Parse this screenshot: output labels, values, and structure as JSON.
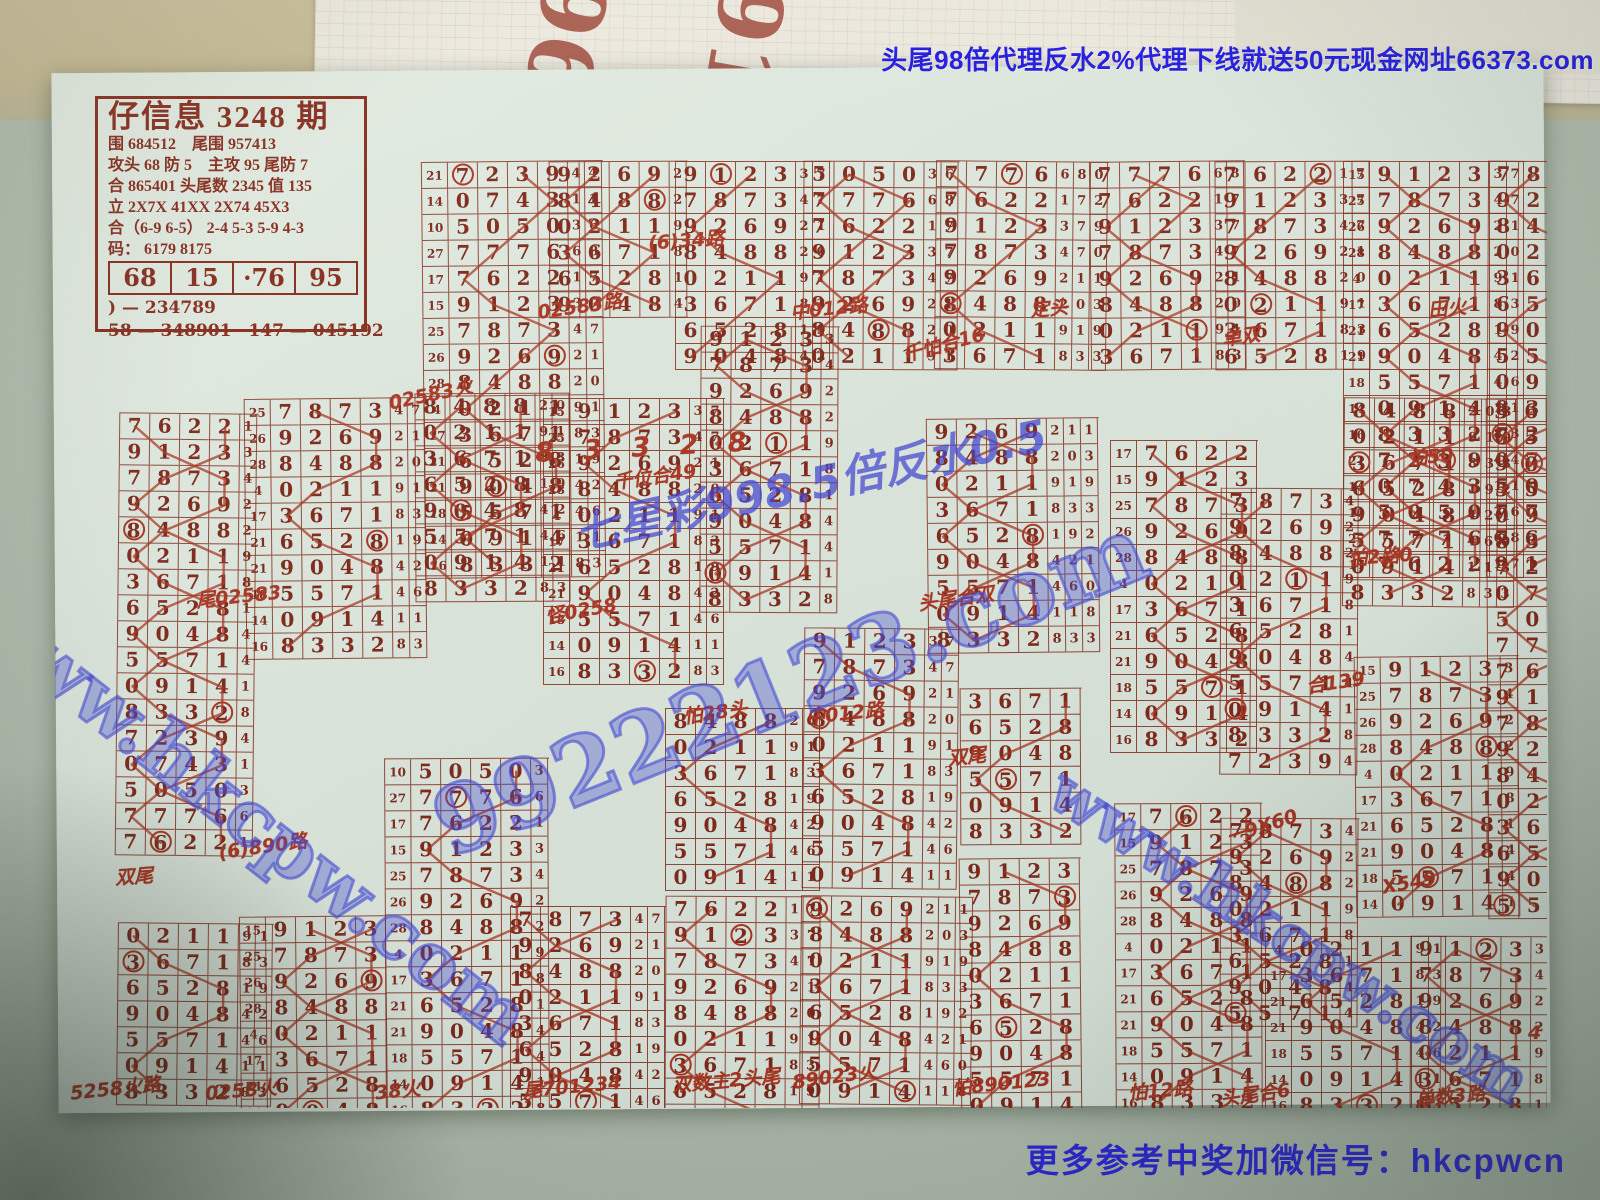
{
  "palette": {
    "paper": "#dee8df",
    "ink": "#7d2417",
    "pen": "#a8321f",
    "ad-blue": "#1a14e0",
    "watermark-blue": "#4046d8",
    "table-tan": "#c6ba96"
  },
  "banner_top": {
    "text": "头尾98倍代理反水2%代理下线就送50元现金网址66373.com"
  },
  "footer_contact": {
    "text": "更多参考中奖加微信号：hkcpwcn"
  },
  "under_paper": {
    "numbers": [
      "96",
      "91"
    ]
  },
  "header_box": {
    "title": "仔信息 3248 期",
    "lines": [
      "围 684512　尾围 957413",
      "攻头 68 防 5　主攻 95 尾防 7",
      "合 865401 头尾数 2345 值 135",
      "立 2X7X 41XX 2X74 45X3",
      "合（6-9 6-5） 2-4 5-3 5-9 4-3",
      "码： 6179 8175"
    ],
    "row_values": [
      "68",
      "15",
      "·76",
      "95"
    ],
    "bottom_lines": [
      ") — 234789",
      "58 — 348901　147 — 045192"
    ]
  },
  "draw_table": {
    "sums": [
      21,
      14,
      10,
      27,
      17,
      15,
      25,
      26,
      28,
      4,
      17,
      21,
      21,
      18,
      14,
      16
    ],
    "draws": [
      "7239",
      "0743",
      "5050",
      "7776",
      "7622",
      "9123",
      "7873",
      "9269",
      "8488",
      "0211",
      "3671",
      "6528",
      "9048",
      "5571",
      "0914",
      "8332"
    ],
    "tails": [
      "443",
      "118",
      "360",
      "680",
      "172",
      "379",
      "470",
      "211",
      "203",
      "919",
      "833",
      "192",
      "421",
      "460",
      "118",
      "833"
    ]
  },
  "grids": [
    {
      "x": 368,
      "y": 93,
      "rows": 16,
      "off": 0,
      "sum": true,
      "tails": 2
    },
    {
      "x": 494,
      "y": 93,
      "rows": 6,
      "off": 7,
      "sum": false,
      "tails": 1
    },
    {
      "x": 620,
      "y": 93,
      "rows": 8,
      "off": 5,
      "sum": false,
      "tails": 2
    },
    {
      "x": 748,
      "y": 93,
      "rows": 8,
      "off": 2,
      "sum": false,
      "tails": 2
    },
    {
      "x": 880,
      "y": 93,
      "rows": 8,
      "off": 3,
      "sum": false,
      "tails": 3
    },
    {
      "x": 1035,
      "y": 93,
      "rows": 8,
      "off": 3,
      "sum": false,
      "tails": 2
    },
    {
      "x": 1160,
      "y": 93,
      "rows": 8,
      "off": 4,
      "sum": false,
      "tails": 2
    },
    {
      "x": 1288,
      "y": 93,
      "rows": 16,
      "off": 5,
      "sum": true,
      "tails": 2
    },
    {
      "x": 1432,
      "y": 93,
      "rows": 16,
      "off": 6,
      "sum": false,
      "tails": 0
    },
    {
      "x": 62,
      "y": 345,
      "rows": 17,
      "off": 4,
      "sum": false,
      "tails": 1
    },
    {
      "x": 190,
      "y": 330,
      "rows": 10,
      "off": 6,
      "sum": true,
      "tails": 2
    },
    {
      "x": 360,
      "y": 325,
      "rows": 8,
      "off": 8,
      "sum": false,
      "tails": 2
    },
    {
      "x": 488,
      "y": 330,
      "rows": 11,
      "off": 5,
      "sum": true,
      "tails": 2
    },
    {
      "x": 645,
      "y": 258,
      "rows": 11,
      "off": 5,
      "sum": false,
      "tails": 1
    },
    {
      "x": 748,
      "y": 560,
      "rows": 10,
      "off": 5,
      "sum": false,
      "tails": 2
    },
    {
      "x": 872,
      "y": 350,
      "rows": 9,
      "off": 7,
      "sum": false,
      "tails": 3
    },
    {
      "x": 905,
      "y": 620,
      "rows": 6,
      "off": 10,
      "sum": false,
      "tails": 0
    },
    {
      "x": 1055,
      "y": 372,
      "rows": 12,
      "off": 4,
      "sum": true,
      "tails": 0
    },
    {
      "x": 1165,
      "y": 420,
      "rows": 11,
      "off": 6,
      "sum": false,
      "tails": 1
    },
    {
      "x": 1288,
      "y": 330,
      "rows": 8,
      "off": 8,
      "sum": false,
      "tails": 3
    },
    {
      "x": 1300,
      "y": 588,
      "rows": 10,
      "off": 5,
      "sum": true,
      "tails": 1
    },
    {
      "x": 1432,
      "y": 330,
      "rows": 20,
      "off": 10,
      "sum": false,
      "tails": 0
    },
    {
      "x": 610,
      "y": 640,
      "rows": 7,
      "off": 8,
      "sum": false,
      "tails": 2
    },
    {
      "x": 1165,
      "y": 750,
      "rows": 8,
      "off": 6,
      "sum": false,
      "tails": 1
    },
    {
      "x": 62,
      "y": 855,
      "rows": 7,
      "off": 9,
      "sum": false,
      "tails": 2
    },
    {
      "x": 185,
      "y": 848,
      "rows": 8,
      "off": 5,
      "sum": true,
      "tails": 0
    },
    {
      "x": 330,
      "y": 690,
      "rows": 14,
      "off": 2,
      "sum": true,
      "tails": 1
    },
    {
      "x": 455,
      "y": 838,
      "rows": 8,
      "off": 6,
      "sum": false,
      "tails": 2
    },
    {
      "x": 610,
      "y": 828,
      "rows": 9,
      "off": 4,
      "sum": false,
      "tails": 2
    },
    {
      "x": 745,
      "y": 828,
      "rows": 8,
      "off": 7,
      "sum": false,
      "tails": 3
    },
    {
      "x": 905,
      "y": 790,
      "rows": 10,
      "off": 5,
      "sum": false,
      "tails": 0
    },
    {
      "x": 1060,
      "y": 735,
      "rows": 12,
      "off": 4,
      "sum": true,
      "tails": 0
    },
    {
      "x": 1210,
      "y": 868,
      "rows": 7,
      "off": 9,
      "sum": true,
      "tails": 2
    },
    {
      "x": 1355,
      "y": 868,
      "rows": 7,
      "off": 5,
      "sum": false,
      "tails": 2
    }
  ],
  "annotations": [
    {
      "x": 537,
      "y": 306,
      "rot": -8,
      "text": "02583路"
    },
    {
      "x": 648,
      "y": 240,
      "rot": -4,
      "text": "(6)34路"
    },
    {
      "x": 790,
      "y": 308,
      "rot": -6,
      "text": "中012路"
    },
    {
      "x": 902,
      "y": 344,
      "rot": -15,
      "text": "千怕合16"
    },
    {
      "x": 1030,
      "y": 308,
      "rot": -5,
      "text": "定头"
    },
    {
      "x": 1222,
      "y": 336,
      "rot": -8,
      "text": "单双"
    },
    {
      "x": 1428,
      "y": 308,
      "rot": -6,
      "text": "田火"
    },
    {
      "x": 388,
      "y": 394,
      "rot": -12,
      "text": "02583火"
    },
    {
      "x": 613,
      "y": 476,
      "rot": -8,
      "text": "千位合49"
    },
    {
      "x": 196,
      "y": 596,
      "rot": -6,
      "text": "尾02583"
    },
    {
      "x": 545,
      "y": 610,
      "rot": -10,
      "text": "怪0258"
    },
    {
      "x": 918,
      "y": 598,
      "rot": -8,
      "text": "头尾合双"
    },
    {
      "x": 1348,
      "y": 556,
      "rot": -4,
      "text": "怕2路0"
    },
    {
      "x": 1408,
      "y": 456,
      "rot": -6,
      "text": "怕50"
    },
    {
      "x": 683,
      "y": 712,
      "rot": -8,
      "text": "怕28头"
    },
    {
      "x": 806,
      "y": 713,
      "rot": -6,
      "text": "中012路"
    },
    {
      "x": 115,
      "y": 876,
      "rot": -4,
      "text": "双尾"
    },
    {
      "x": 218,
      "y": 846,
      "rot": -8,
      "text": "(6)890路"
    },
    {
      "x": 948,
      "y": 756,
      "rot": -6,
      "text": "双尾"
    },
    {
      "x": 1225,
      "y": 826,
      "rot": -18,
      "text": "一9X60"
    },
    {
      "x": 1382,
      "y": 886,
      "rot": -10,
      "text": "X549"
    },
    {
      "x": 1306,
      "y": 682,
      "rot": -8,
      "text": "合139"
    },
    {
      "x": 70,
      "y": 1088,
      "rot": -6,
      "text": "5258火路"
    },
    {
      "x": 205,
      "y": 1090,
      "rot": -5,
      "text": "0258火"
    },
    {
      "x": 375,
      "y": 1090,
      "rot": -6,
      "text": "38火"
    },
    {
      "x": 523,
      "y": 1086,
      "rot": -5,
      "text": "尾701234"
    },
    {
      "x": 672,
      "y": 1080,
      "rot": -5,
      "text": "双数主2头尾"
    },
    {
      "x": 792,
      "y": 1076,
      "rot": -8,
      "text": "89023火"
    },
    {
      "x": 952,
      "y": 1083,
      "rot": -6,
      "text": "怕890123"
    },
    {
      "x": 1128,
      "y": 1090,
      "rot": -5,
      "text": "怕12路"
    },
    {
      "x": 1220,
      "y": 1094,
      "rot": -8,
      "text": "头尾合6"
    },
    {
      "x": 1415,
      "y": 1096,
      "rot": -6,
      "text": "单数3路"
    },
    {
      "x": 535,
      "y": 446,
      "rot": -3,
      "text": "8 3 3 2 8",
      "big": true
    },
    {
      "x": 1528,
      "y": 1036,
      "rot": 0,
      "text": "4"
    }
  ],
  "watermarks": [
    {
      "text": "www.hkcpw.com",
      "x": 250,
      "y": 830,
      "rot": 38,
      "size": 76,
      "style": "outline"
    },
    {
      "text": "99222123.com",
      "x": 790,
      "y": 700,
      "rot": -22,
      "size": 92,
      "style": "outline"
    },
    {
      "text": "七星彩998.5倍反水0.5",
      "x": 810,
      "y": 495,
      "rot": -12,
      "size": 44,
      "style": "solid"
    },
    {
      "text": "www.hkcpw.com",
      "x": 1290,
      "y": 950,
      "rot": 33,
      "size": 62,
      "style": "outline"
    }
  ]
}
